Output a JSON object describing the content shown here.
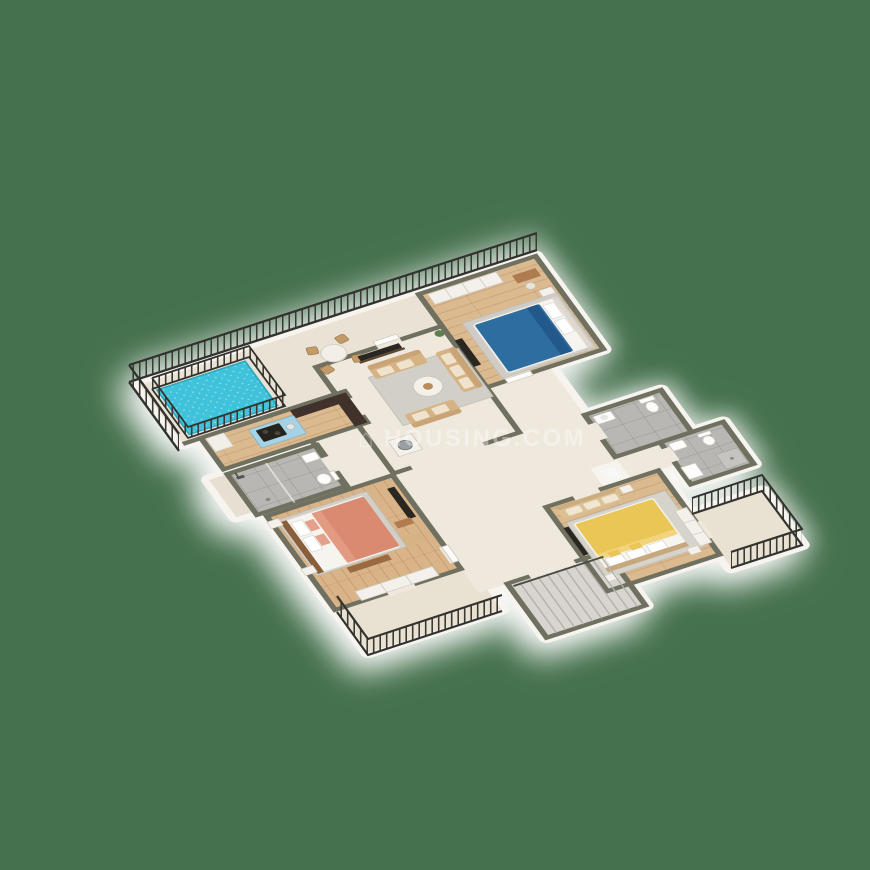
{
  "background_color": "#46714E",
  "watermark": {
    "logo_icon": "⌂",
    "text": "HOUSING.COM"
  },
  "view": {
    "type": "isometric-3d-floor-plan",
    "style": "rendered dollhouse cutaway"
  },
  "palette": {
    "background": "#46714E",
    "wall_top": "#6F6F60",
    "wall_face": "#F7F4EF",
    "wood_floor": "#DCBA90",
    "cream_floor": "#EFE8DC",
    "terrace_floor": "#EAE3D5",
    "balcony_floor": "#E9E1D2",
    "tile_floor": "#B9B7B3",
    "pool_water": "#3FC3DA",
    "railing": "#3A3A34",
    "sofa_tan": "#D6B385",
    "bed_blue": "#2F6DA0",
    "bed_coral": "#D98A70",
    "bed_yellow": "#E9C654",
    "kitchen_island_blue": "#A5D2E4",
    "counter_dark": "#40332A",
    "rug_gray": "#D2CFC8"
  },
  "rooms": [
    {
      "id": "terrace",
      "floor": "cream marble",
      "features": [
        "plunge-pool with fence",
        "round dining table",
        "4 wicker chairs",
        "perimeter railing"
      ]
    },
    {
      "id": "living-room",
      "floor": "cream",
      "features": [
        "3 tan sofas",
        "round coffee table",
        "gray rug",
        "wall tv",
        "plant"
      ]
    },
    {
      "id": "kitchen",
      "floor": "wood",
      "features": [
        "blue island with cooktop",
        "dark L-counter",
        "fridge"
      ]
    },
    {
      "id": "hallway",
      "floor": "cream",
      "features": [
        "washing machine",
        "stair handrail"
      ]
    },
    {
      "id": "bedroom-blue",
      "floor": "wood",
      "features": [
        "blue double bed",
        "wardrobe",
        "desk and stool",
        "tv",
        "gray rug"
      ]
    },
    {
      "id": "bedroom-coral",
      "floor": "wood",
      "features": [
        "coral double bed",
        "nightstands",
        "tv unit",
        "armchair",
        "bench",
        "sliding wardrobe"
      ]
    },
    {
      "id": "bedroom-yellow",
      "floor": "wood",
      "features": [
        "yellow double bed",
        "loveseat",
        "tv",
        "wardrobe"
      ]
    },
    {
      "id": "bathroom-west",
      "floor": "gray tile",
      "features": [
        "shower",
        "sink",
        "toilet"
      ]
    },
    {
      "id": "bathroom-a",
      "floor": "gray tile",
      "features": [
        "sink",
        "toilet"
      ]
    },
    {
      "id": "bathroom-b",
      "floor": "gray tile",
      "features": [
        "sink",
        "toilet",
        "shower tray",
        "washbasin"
      ]
    },
    {
      "id": "staircase",
      "floor": "gray",
      "features": [
        "steps",
        "handrail"
      ]
    },
    {
      "id": "balcony-south",
      "floor": "cream",
      "features": [
        "railing"
      ]
    },
    {
      "id": "balcony-east",
      "floor": "cream",
      "features": [
        "railing"
      ]
    }
  ]
}
